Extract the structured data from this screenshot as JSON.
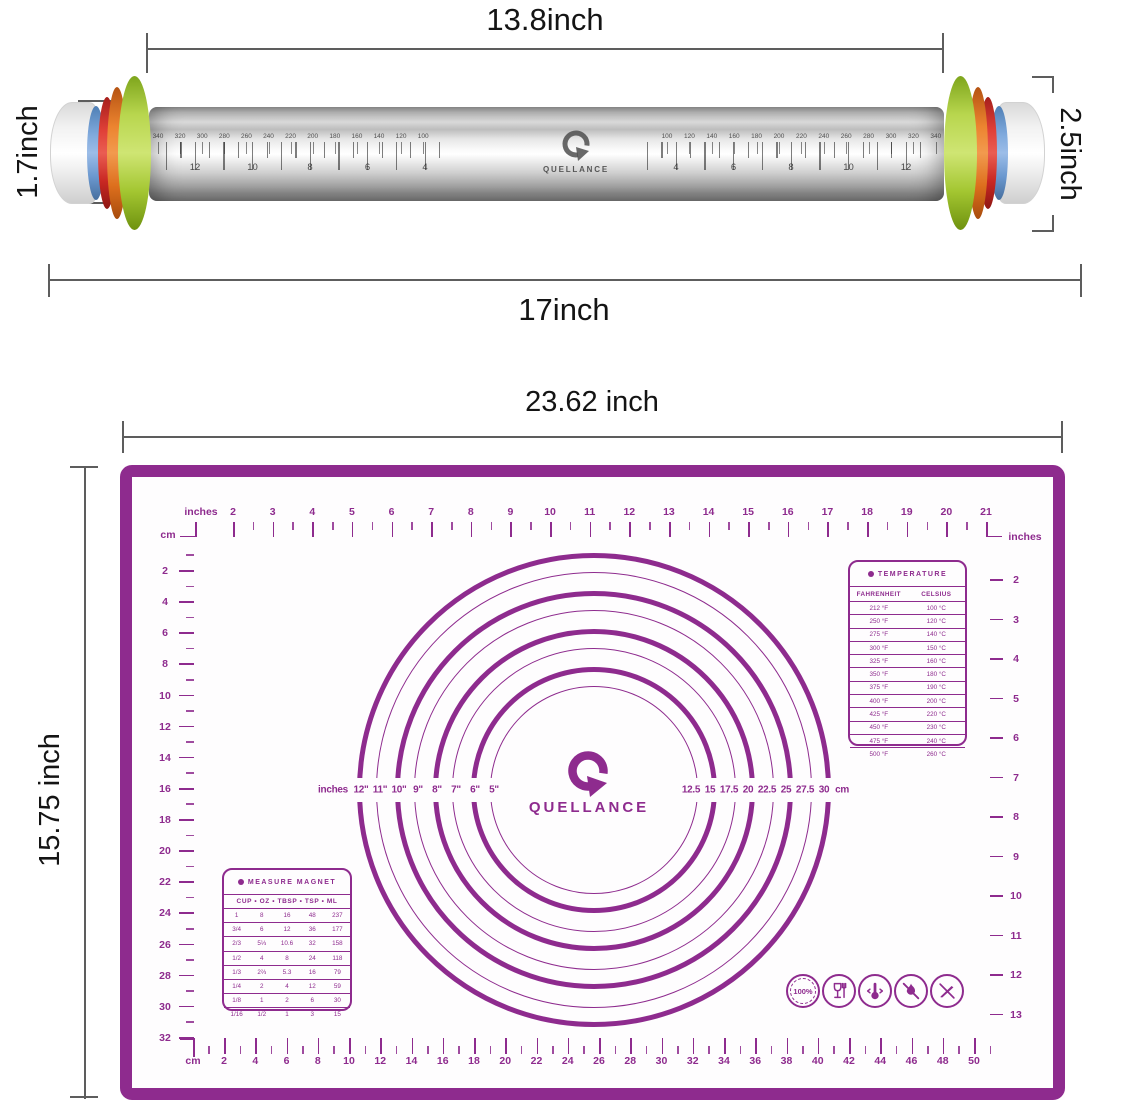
{
  "colors": {
    "purple": "#8e2b8e",
    "dim_line": "#5d5d5d",
    "ring_green": "#a9c93d",
    "ring_orange": "#e4731f",
    "ring_red": "#d8312c",
    "ring_blue": "#6d9bd3"
  },
  "pin": {
    "label_width_top": "13.8inch",
    "label_height_left": "1.7inch",
    "label_height_right": "2.5inch",
    "label_width_bottom": "17inch",
    "brand": "QUELLANCE",
    "mm_scale_left": [
      "340",
      "320",
      "300",
      "280",
      "260",
      "240",
      "220",
      "200",
      "180",
      "160",
      "140",
      "120",
      "100"
    ],
    "inch_scale_left": [
      "12",
      "10",
      "8",
      "6",
      "4"
    ],
    "mm_scale_right": [
      "100",
      "120",
      "140",
      "160",
      "180",
      "200",
      "220",
      "240",
      "260",
      "280",
      "300",
      "320",
      "340"
    ],
    "inch_scale_right": [
      "4",
      "6",
      "8",
      "10",
      "12"
    ]
  },
  "mat": {
    "label_width": "23.62 inch",
    "label_height": "15.75 inch",
    "brand": "QUELLANCE",
    "top_ruler": {
      "unit_left": "inches",
      "unit_cm": "cm",
      "unit_right": "inches",
      "numbers": [
        "2",
        "3",
        "4",
        "5",
        "6",
        "7",
        "8",
        "9",
        "10",
        "11",
        "12",
        "13",
        "14",
        "15",
        "16",
        "17",
        "18",
        "19",
        "20",
        "21"
      ]
    },
    "left_ruler": {
      "numbers": [
        "2",
        "4",
        "6",
        "8",
        "10",
        "12",
        "14",
        "16",
        "18",
        "20",
        "22",
        "24",
        "26",
        "28",
        "30",
        "32"
      ]
    },
    "right_ruler": {
      "numbers": [
        "2",
        "3",
        "4",
        "5",
        "6",
        "7",
        "8",
        "9",
        "10",
        "11",
        "12",
        "13"
      ]
    },
    "bottom_ruler": {
      "unit": "cm",
      "numbers": [
        "2",
        "4",
        "6",
        "8",
        "10",
        "12",
        "14",
        "16",
        "18",
        "20",
        "22",
        "24",
        "26",
        "28",
        "30",
        "32",
        "34",
        "36",
        "38",
        "40",
        "42",
        "44",
        "46",
        "48",
        "50"
      ]
    },
    "circle_labels": {
      "unit_left": "inches",
      "inches": [
        "12\"",
        "11\"",
        "10\"",
        "9\"",
        "8\"",
        "7\"",
        "6\"",
        "5\""
      ],
      "cm": [
        "12.5",
        "15",
        "17.5",
        "20",
        "22.5",
        "25",
        "27.5",
        "30"
      ],
      "unit_right": "cm"
    },
    "temperature_table": {
      "title": "TEMPERATURE",
      "columns": [
        "FAHRENHEIT",
        "CELSIUS"
      ],
      "rows": [
        [
          "212 °F",
          "100 °C"
        ],
        [
          "250 °F",
          "120 °C"
        ],
        [
          "275 °F",
          "140 °C"
        ],
        [
          "300 °F",
          "150 °C"
        ],
        [
          "325 °F",
          "160 °C"
        ],
        [
          "350 °F",
          "180 °C"
        ],
        [
          "375 °F",
          "190 °C"
        ],
        [
          "400 °F",
          "200 °C"
        ],
        [
          "425 °F",
          "220 °C"
        ],
        [
          "450 °F",
          "230 °C"
        ],
        [
          "475 °F",
          "240 °C"
        ],
        [
          "500 °F",
          "260 °C"
        ]
      ]
    },
    "measure_table": {
      "title": "MEASURE MAGNET",
      "header": "CUP • OZ • TBSP • TSP • ML",
      "rows": [
        [
          "1",
          "8",
          "16",
          "48",
          "237"
        ],
        [
          "3/4",
          "6",
          "12",
          "36",
          "177"
        ],
        [
          "2/3",
          "5⅓",
          "10.6",
          "32",
          "158"
        ],
        [
          "1/2",
          "4",
          "8",
          "24",
          "118"
        ],
        [
          "1/3",
          "2⅔",
          "5.3",
          "16",
          "79"
        ],
        [
          "1/4",
          "2",
          "4",
          "12",
          "59"
        ],
        [
          "1/8",
          "1",
          "2",
          "6",
          "30"
        ],
        [
          "1/16",
          "1/2",
          "1",
          "3",
          "15"
        ]
      ]
    },
    "badge_100": "100%"
  }
}
